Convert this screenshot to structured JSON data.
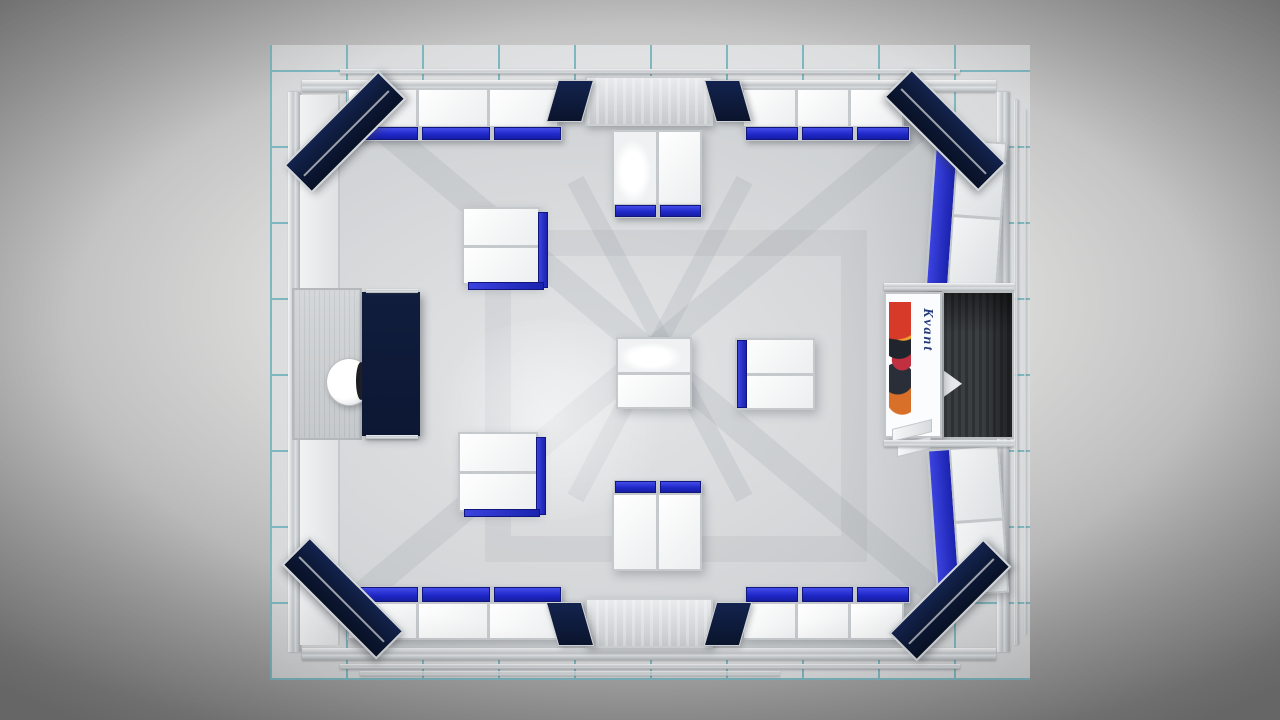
{
  "meta": {
    "title": "Exhibition booth 3D render - top view",
    "view": "top-down orthographic render"
  },
  "palette": {
    "navy": "#0c1733",
    "blue": "#2029c9",
    "grout": "#7fb7c0",
    "tile": "#e1e2e3",
    "floor": "#d7d9db",
    "aluminum": "#c5c9cc",
    "dark": "#3b3f42",
    "white": "#fbfcfd"
  },
  "scene": {
    "description": "Top view rendering of a modular exhibition stand with aluminum frame walls on a tiled floor",
    "floor": {
      "tile_grid": "10 x 8 tiles",
      "grout_color": "#7fb7c0"
    },
    "booth": {
      "corner_headers": 4,
      "corner_header_color": "#0c1733",
      "accent_color": "#2029c9",
      "entrances": [
        "top center",
        "bottom center"
      ]
    },
    "objects": [
      {
        "name": "perimeter counter row top-left",
        "bays": 3,
        "accent": "blue band"
      },
      {
        "name": "perimeter counter row top-right",
        "bays": 3,
        "accent": "blue band"
      },
      {
        "name": "perimeter counter row bottom-left",
        "bays": 3,
        "accent": "blue top"
      },
      {
        "name": "perimeter counter row bottom-right",
        "bays": 3,
        "accent": "blue top"
      },
      {
        "name": "island counter upper-left",
        "bays": 2
      },
      {
        "name": "island counter lower-left",
        "bays": 2
      },
      {
        "name": "island counter top-center",
        "bays": 2
      },
      {
        "name": "island counter bottom-center",
        "bays": 2
      },
      {
        "name": "center display counter illuminated",
        "bays": 2
      },
      {
        "name": "center display counter blue-edge",
        "bays": 2
      },
      {
        "name": "wall shelf unit right-upper",
        "bays": 2,
        "accent": "blue panel"
      },
      {
        "name": "wall shelf unit right-lower",
        "bays": 2,
        "accent": "blue panel"
      },
      {
        "name": "brand graphic tower",
        "graphic": "multicolor logo collage"
      },
      {
        "name": "storage room dark interior"
      },
      {
        "name": "meeting desk navy"
      },
      {
        "name": "office chair white round"
      },
      {
        "name": "slatted platform"
      }
    ],
    "brand": {
      "text": "Kvant",
      "orientation": "vertical",
      "color": "#233a7c"
    }
  }
}
